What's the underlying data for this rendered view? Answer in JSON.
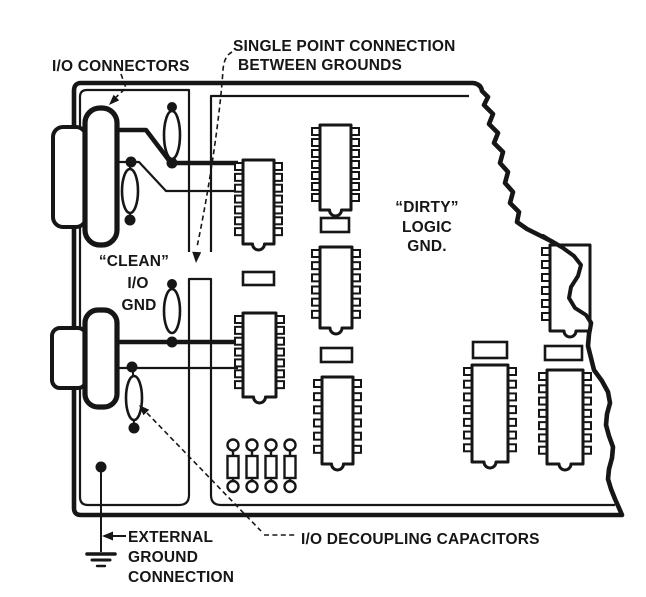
{
  "labels": {
    "io_connectors": "I/O CONNECTORS",
    "single_point": [
      "SINGLE POINT CONNECTION",
      "BETWEEN GROUNDS"
    ],
    "clean_gnd": [
      "“CLEAN”",
      "I/O",
      "GND"
    ],
    "dirty_gnd": [
      "“DIRTY”",
      "LOGIC",
      "GND."
    ],
    "external_ground": [
      "EXTERNAL",
      "GROUND",
      "CONNECTION"
    ],
    "decoupling": "I/O DECOUPLING CAPACITORS"
  },
  "colors": {
    "ink": "#161616",
    "paper": "#ffffff"
  }
}
